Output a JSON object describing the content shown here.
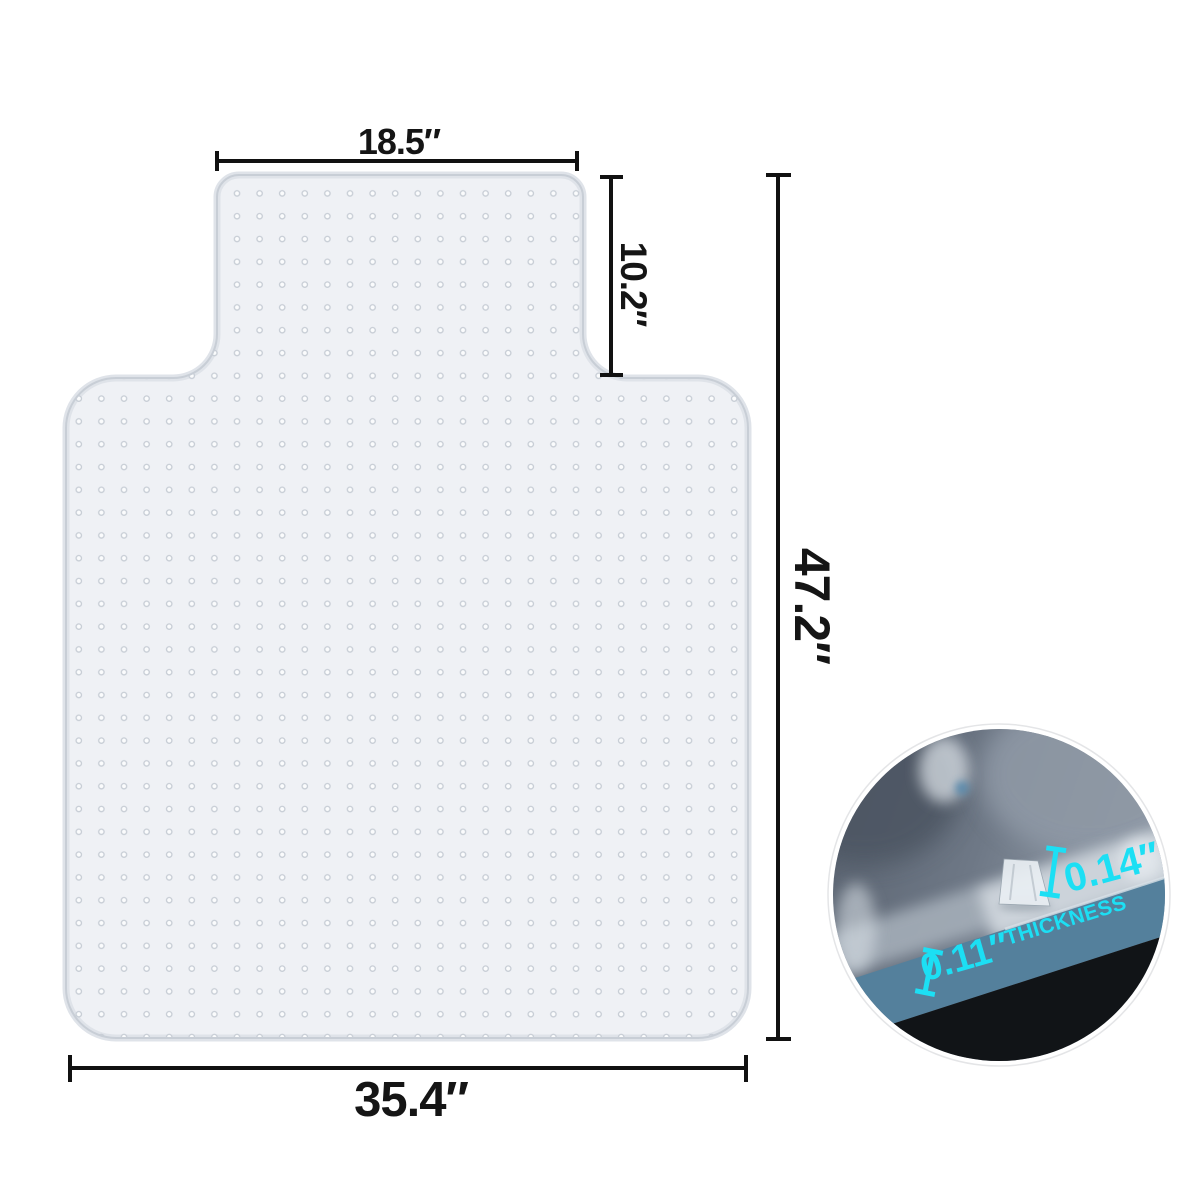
{
  "diagram": {
    "dimensions": {
      "lip_width": "18.5″",
      "lip_depth": "10.2″",
      "overall_length": "47.2″",
      "overall_width": "35.4″"
    },
    "inset": {
      "stud_height": "0.14″",
      "thickness_value": "0.11″",
      "thickness_label": "THICKNESS"
    },
    "colors": {
      "accent_cyan": "#1CDFF4",
      "dimension_ink": "#151515",
      "dimension_line": "#111111",
      "mat_fill": "#eff1f5",
      "mat_edge": "#c8ced6",
      "inset_band_blue": "#54809c",
      "inset_floor_black": "#111417"
    }
  }
}
